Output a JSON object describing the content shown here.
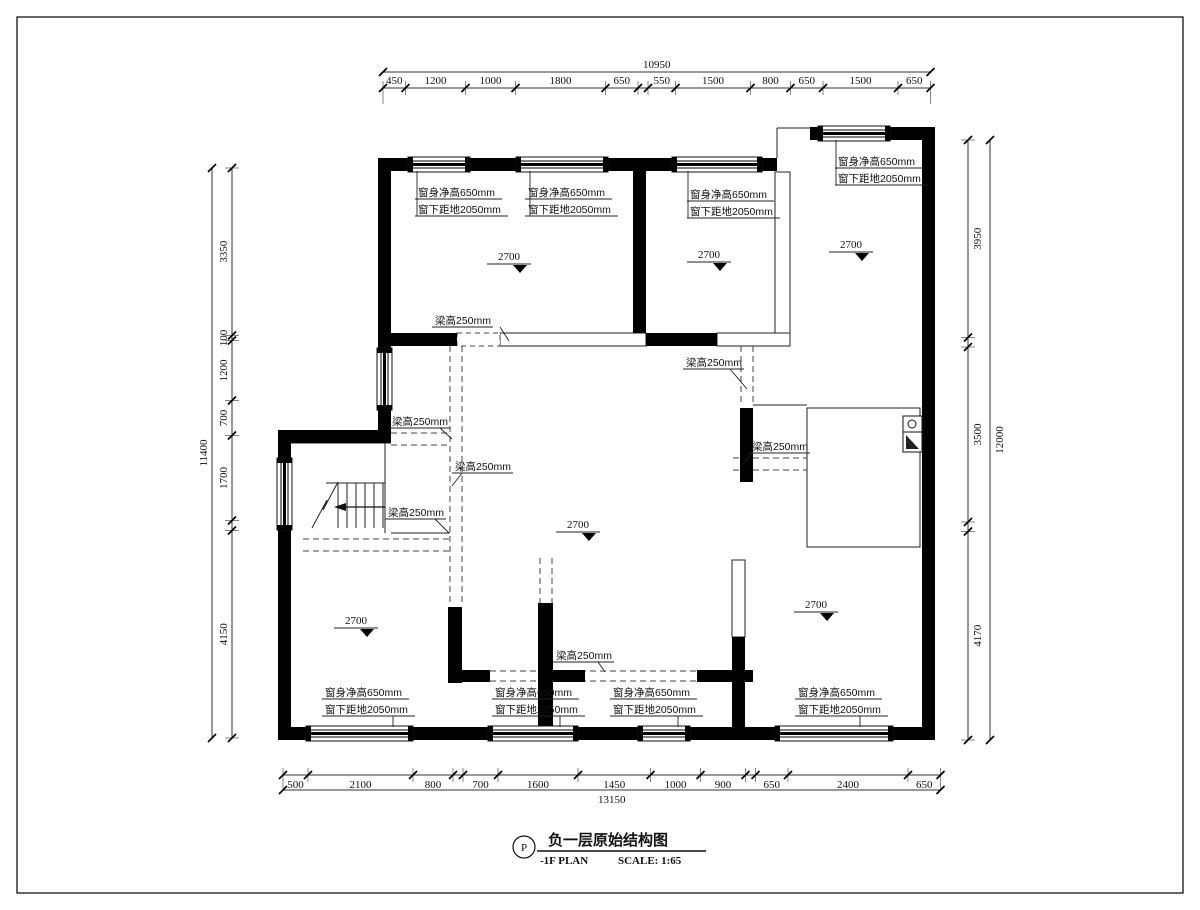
{
  "drawing": {
    "tag": "P",
    "title_cn": "负一层原始结构图",
    "title_en": "-1F PLAN",
    "scale_label": "SCALE: 1:65"
  },
  "dimensions": {
    "top": {
      "total": "10950",
      "segments": [
        "450",
        "1200",
        "1000",
        "1800",
        "650",
        "550",
        "1500",
        "800",
        "650",
        "1500",
        "650"
      ]
    },
    "bottom": {
      "total": "13150",
      "segments": [
        "500",
        "2100",
        "800",
        "700",
        "1600",
        "1450",
        "1000",
        "900",
        "650",
        "2400",
        "650"
      ]
    },
    "left": {
      "total": "11400",
      "segments": [
        "3350",
        "100",
        "1200",
        "700",
        "1700",
        "4150"
      ]
    },
    "right": {
      "total": "12000",
      "segments": [
        "3950",
        "3500",
        "4170"
      ]
    }
  },
  "notes": {
    "window_height": "窗身净高650mm",
    "window_sill": "窗下距地2050mm",
    "beam_height": "梁高250mm",
    "ceiling_height": "2700"
  },
  "colors": {
    "wall": "#000000",
    "line": "#222222",
    "dashed": "#444444",
    "dim": "#333333",
    "background": "#ffffff"
  }
}
